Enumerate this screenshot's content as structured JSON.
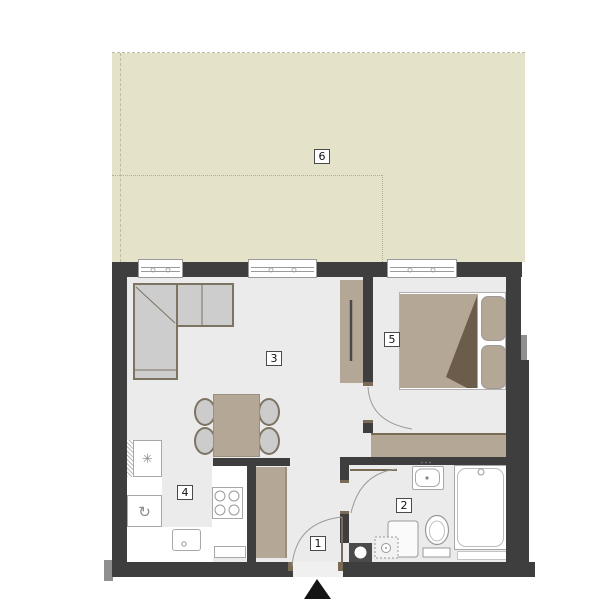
{
  "plan": {
    "type": "apartment-floor-plan",
    "room_labels": [
      "1",
      "2",
      "3",
      "4",
      "5",
      "6"
    ]
  },
  "rooms": [
    {
      "label": "1"
    },
    {
      "label": "2"
    },
    {
      "label": "3"
    },
    {
      "label": "4"
    },
    {
      "label": "5"
    },
    {
      "label": "6"
    }
  ],
  "icons": {
    "fridge_symbol": "✳",
    "washer_symbol": "↻",
    "entrance_marker": "filled-triangle-up"
  },
  "colors": {
    "wall": "#3e3e3e",
    "floor": "#ebebeb",
    "terrace": "#e4e3ca",
    "furniture": "#b5a795",
    "furniture_outline": "#7d7361",
    "upholstery": "#cdcdcd",
    "fixture_line": "#999999",
    "blanket_fold": "#6b5c4b",
    "exterior": "#ffffff",
    "marker": "#141414"
  }
}
